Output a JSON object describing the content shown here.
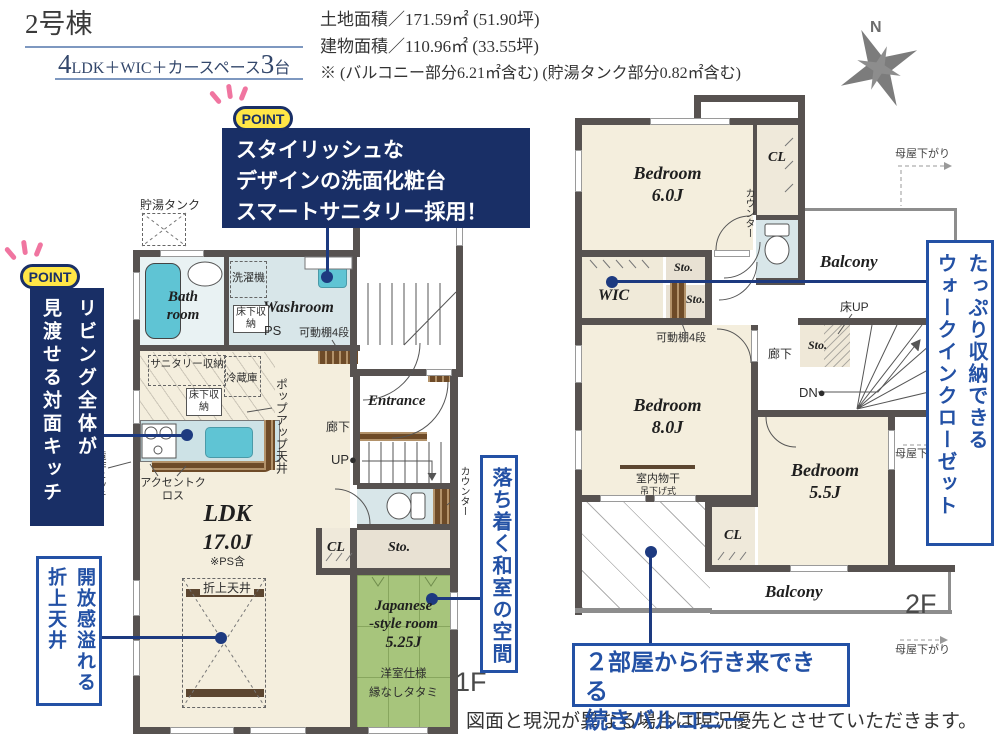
{
  "header": {
    "unit_name": "2号棟",
    "plan_num1": "4",
    "plan_mid": "LDK＋WIC＋カースペース",
    "plan_num2": "3",
    "plan_tail": "台",
    "land_area": "土地面積／171.59㎡ (51.90坪)",
    "building_area": "建物面積／110.96㎡ (33.55坪)",
    "area_note": "※ (バルコニー部分6.21㎡含む) (貯湯タンク部分0.82㎡含む)",
    "compass_n": "N"
  },
  "callouts": {
    "point_badge": "POINT",
    "vanity": {
      "line1": "スタイリッシュな",
      "line2": "デザインの洗面化粧台",
      "line3": "スマートサニタリー採用！"
    },
    "kitchen": {
      "col1": "リビング全体が",
      "col2": "見渡せる対面キッチン"
    },
    "ceiling": {
      "col1": "開放感溢れる",
      "col2": "折上天井"
    },
    "washitsu": {
      "text": "落ち着く和室の空間"
    },
    "wic": {
      "col1": "たっぷり収納できる",
      "col2": "ウォークインクローゼット"
    },
    "balcony": {
      "line1": "２部屋から行き来できる",
      "line2": "続きバルコニー"
    }
  },
  "floor1": {
    "floor_label": "1F",
    "tank": "貯湯タンク",
    "bath1": "Bath",
    "bath2": "room",
    "washer": "洗濯機",
    "washroom": "Washroom",
    "underfloor1": "床下収納",
    "ps": "PS",
    "shelf": "可動棚4段",
    "sanitary": "サニタリー収納",
    "fridge": "冷蔵庫",
    "underfloor2": "床下収納",
    "popup": "ポップアップ天井",
    "accent": "アクセントクロス",
    "niche": "造作ニッチ",
    "ldk": "LDK",
    "ldk_size": "17.0J",
    "ps_note": "※PS含",
    "oriage": "折上天井",
    "entrance": "Entrance",
    "hall": "廊下",
    "up": "UP●",
    "cl": "CL",
    "sto": "Sto.",
    "counter": "カウンター",
    "jp1": "Japanese",
    "jp2": "-style room",
    "jp3": "5.25J",
    "jp4": "洋室仕様",
    "jp5": "縁なしタタミ"
  },
  "floor2": {
    "floor_label": "2F",
    "bed6_1": "Bedroom",
    "bed6_2": "6.0J",
    "cl1": "CL",
    "counter": "カウンター",
    "balcony1": "Balcony",
    "moya1": "母屋下がり",
    "wic": "WIC",
    "sto1": "Sto.",
    "sto2": "Sto.",
    "shelf": "可動棚4段",
    "bed8_1": "Bedroom",
    "bed8_2": "8.0J",
    "hall": "廊下",
    "yuka_up": "床UP",
    "sto3": "Sto.",
    "dn": "DN●",
    "monohoshi": "室内物干",
    "tsuri": "吊下げ式",
    "bed55_1": "Bedroom",
    "bed55_2": "5.5J",
    "cl2": "CL",
    "balcony2": "Balcony",
    "moya2": "母屋下がり",
    "moya3": "母屋下がり"
  },
  "footer": {
    "disclaimer": "図面と現況が異なる場合は現況優先とさせていただきます。"
  },
  "colors": {
    "accent_navy": "#192f66",
    "callout_blue": "#2351a5",
    "point_yellow": "#ffe646",
    "spark_pink": "#f075a0",
    "wall_gray": "#575250",
    "floor_cream": "#f4eedd",
    "water_blue": "#d8e6e9",
    "fixture_cyan": "#5fc4d4",
    "tatami_green": "#a7c57c",
    "wood_brown": "#6e4b28"
  }
}
